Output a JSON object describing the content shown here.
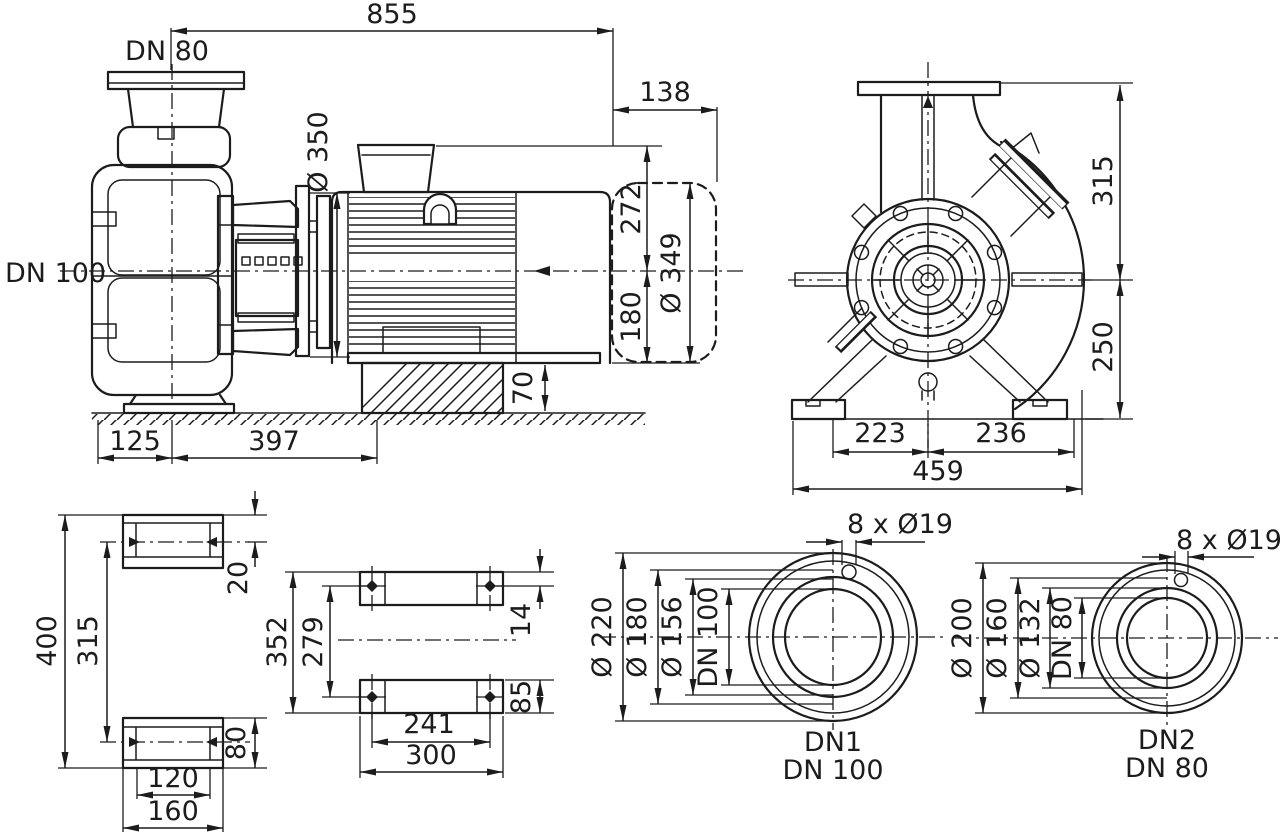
{
  "colors": {
    "ink": "#1c1c1c",
    "background": "#ffffff"
  },
  "side_view": {
    "dim_overall_length": "855",
    "dim_motor_overhang": "138",
    "label_discharge": "DN 80",
    "label_suction": "DN 100",
    "dim_motor_flange_diameter": "Ø 350",
    "dim_centerline_to_top": "272",
    "dim_centerline_to_base": "180",
    "dim_motor_diameter": "Ø 349",
    "dim_foundation_height": "70",
    "dim_suction_to_centerline": "125",
    "dim_centerline_to_foot_end": "397"
  },
  "front_view": {
    "dim_centerline_to_top": "315",
    "dim_centerline_to_base": "250",
    "dim_center_to_left_foot": "223",
    "dim_center_to_right_foot": "236",
    "dim_foot_width_total": "459"
  },
  "foot_front_view": {
    "dim_overall_height": "400",
    "dim_hole_spacing": "315",
    "dim_top_to_hole": "20",
    "dim_foot_height": "80",
    "dim_hole_span": "120",
    "dim_foot_width": "160"
  },
  "foot_plan_view": {
    "dim_plate_length": "352",
    "dim_hole_spacing_length": "279",
    "dim_edge_to_hole": "14",
    "dim_plate_width": "85",
    "dim_hole_spacing_width": "241",
    "dim_plate_span": "300"
  },
  "flange_dn1": {
    "dim_bolt_holes": "8 x Ø19",
    "dim_outer_diameter": "Ø 220",
    "dim_bolt_circle": "Ø 180",
    "dim_raised_face": "Ø 156",
    "dim_nominal_bore": "DN 100",
    "label_port": "DN1",
    "label_nominal": "DN 100"
  },
  "flange_dn2": {
    "dim_bolt_holes": "8 x Ø19",
    "dim_outer_diameter": "Ø 200",
    "dim_bolt_circle": "Ø 160",
    "dim_raised_face": "Ø 132",
    "dim_nominal_bore": "DN 80",
    "label_port": "DN2",
    "label_nominal": "DN 80"
  }
}
